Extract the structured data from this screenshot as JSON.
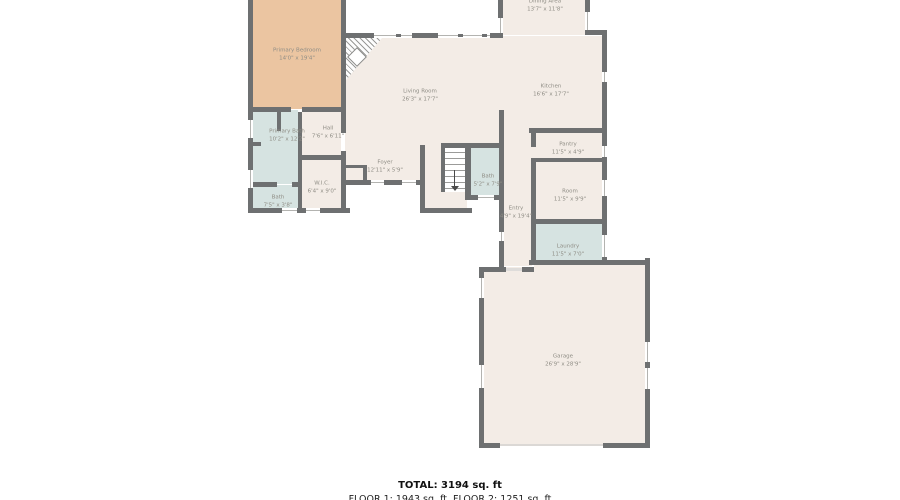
{
  "plan": {
    "title": "Floor plan - Floor 1",
    "colors": {
      "floor_beige": "#f3ece6",
      "bedroom_tan": "#ebc5a1",
      "wet_room_blue": "#d6e3e1",
      "wall_gray": "#6e7071",
      "label_gray": "#8f8d85"
    },
    "rooms": [
      {
        "name": "Primary Bedroom",
        "dims": "14'0\" x 19'4\""
      },
      {
        "name": "Dining Area",
        "dims": "13'7\" x 11'8\""
      },
      {
        "name": "Living Room",
        "dims": "26'3\" x 17'7\""
      },
      {
        "name": "Kitchen",
        "dims": "16'6\" x 17'7\""
      },
      {
        "name": "Primary Bath",
        "dims": "10'2\" x 12'2\""
      },
      {
        "name": "Hall",
        "dims": "7'6\" x 6'11\""
      },
      {
        "name": "W.I.C.",
        "dims": "6'4\" x 9'0\""
      },
      {
        "name": "Bath",
        "dims": "7'5\" x 3'8\""
      },
      {
        "name": "Foyer",
        "dims": "12'11\" x 5'9\""
      },
      {
        "name": "Bath",
        "dims": "5'2\" x 7'9\""
      },
      {
        "name": "Pantry",
        "dims": "11'5\" x 4'9\""
      },
      {
        "name": "Room",
        "dims": "11'5\" x 9'9\""
      },
      {
        "name": "Entry",
        "dims": "4'9\" x 19'4\""
      },
      {
        "name": "Laundry",
        "dims": "11'5\" x 7'0\""
      },
      {
        "name": "Garage",
        "dims": "26'9\" x 28'9\""
      }
    ],
    "footer": {
      "total": "TOTAL: 3194 sq. ft",
      "floors": "FLOOR 1: 1943 sq. ft. FLOOR 2: 1251 sq. ft"
    }
  }
}
